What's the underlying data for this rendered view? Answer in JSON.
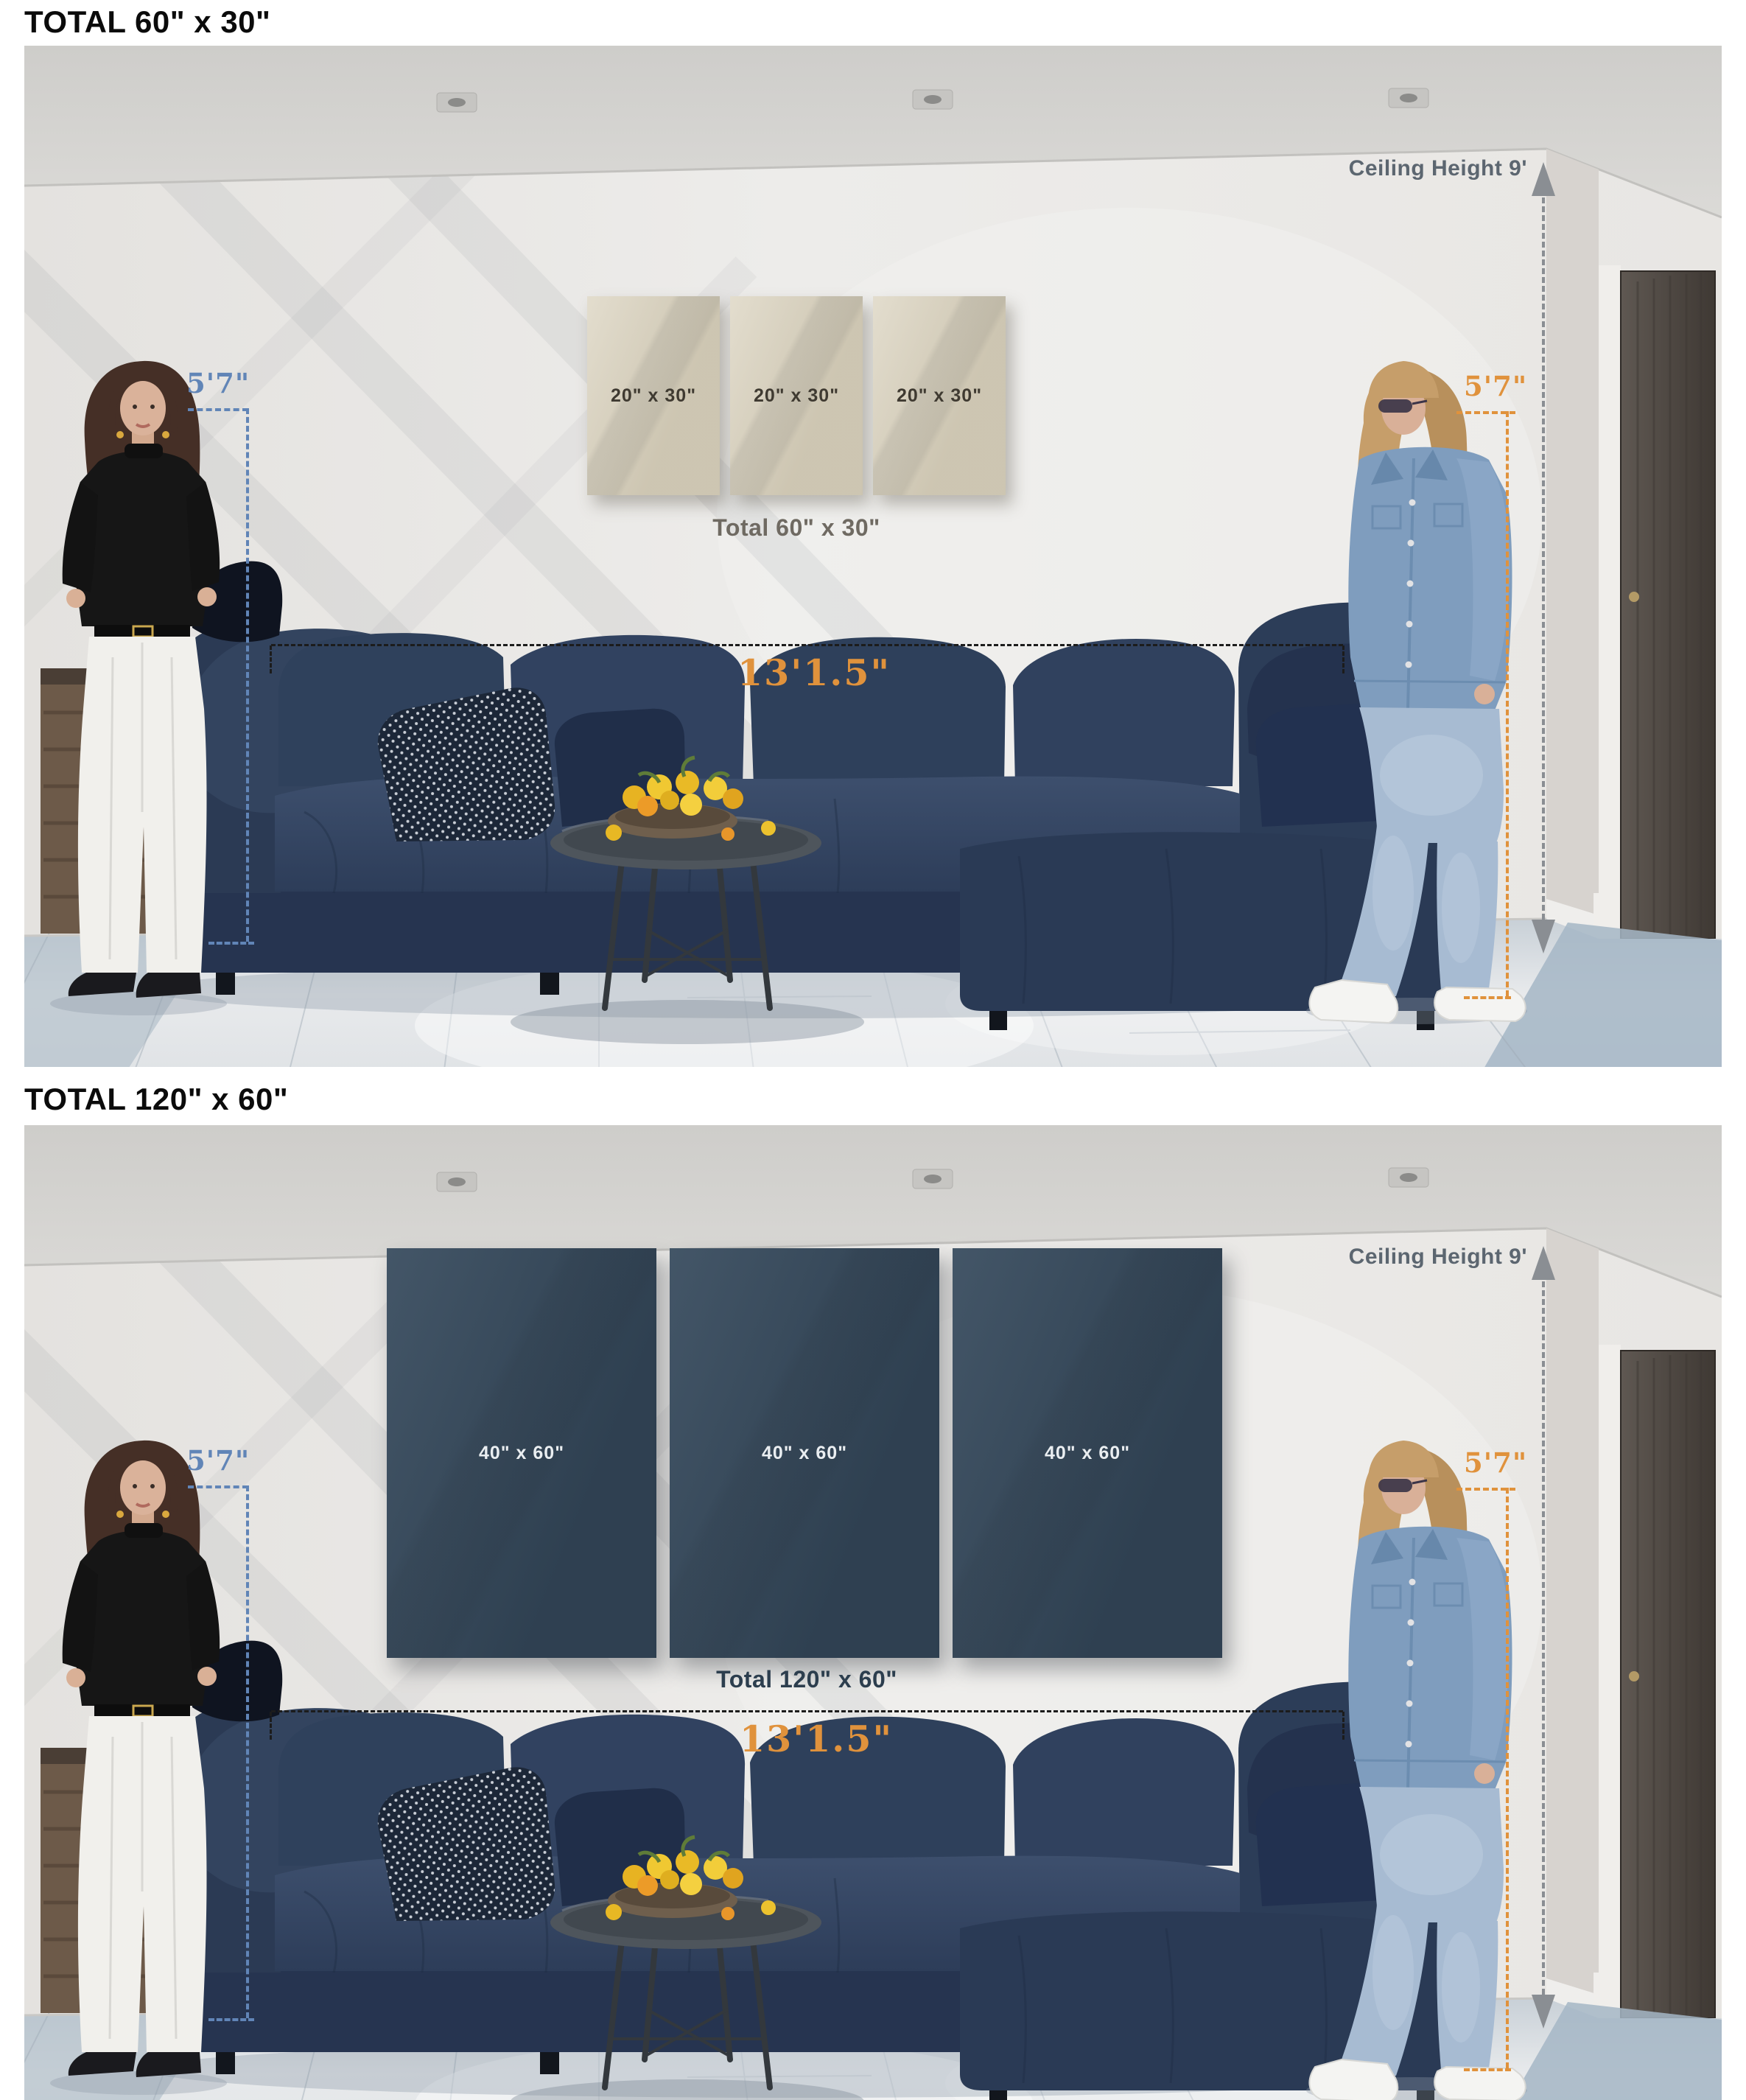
{
  "panels": [
    {
      "title": "TOTAL 60\" x 30\"",
      "canvases": [
        "20\" x 30\"",
        "20\" x 30\"",
        "20\" x 30\""
      ],
      "total_label": "Total 60\" x 30\"",
      "width_label": "13'1.5\"",
      "ceiling_label": "Ceiling Height 9'",
      "height_left": "5'7\"",
      "height_right": "5'7\""
    },
    {
      "title": "TOTAL 120\" x 60\"",
      "canvases": [
        "40\" x 60\"",
        "40\" x 60\"",
        "40\" x 60\""
      ],
      "total_label": "Total 120\" x 60\"",
      "width_label": "13'1.5\"",
      "ceiling_label": "Ceiling Height 9'",
      "height_left": "5'7\"",
      "height_right": "5'7\""
    }
  ],
  "colors": {
    "page_bg": "#ffffff",
    "title_color": "#0b0b0b",
    "accent_orange": "#e0923c",
    "accent_blue": "#6185b7",
    "dim_black": "#1c1c1c",
    "gray_line": "#8a8e93",
    "ceiling_text": "#5c6670",
    "total1_color": "#6f6a62",
    "total2_color": "#2c3e4e",
    "canvas1_bg": "#d8d0bb",
    "canvas1_text": "#3f3a31",
    "canvas2_bg": "#35495c",
    "canvas2_text": "#eaeef1"
  }
}
